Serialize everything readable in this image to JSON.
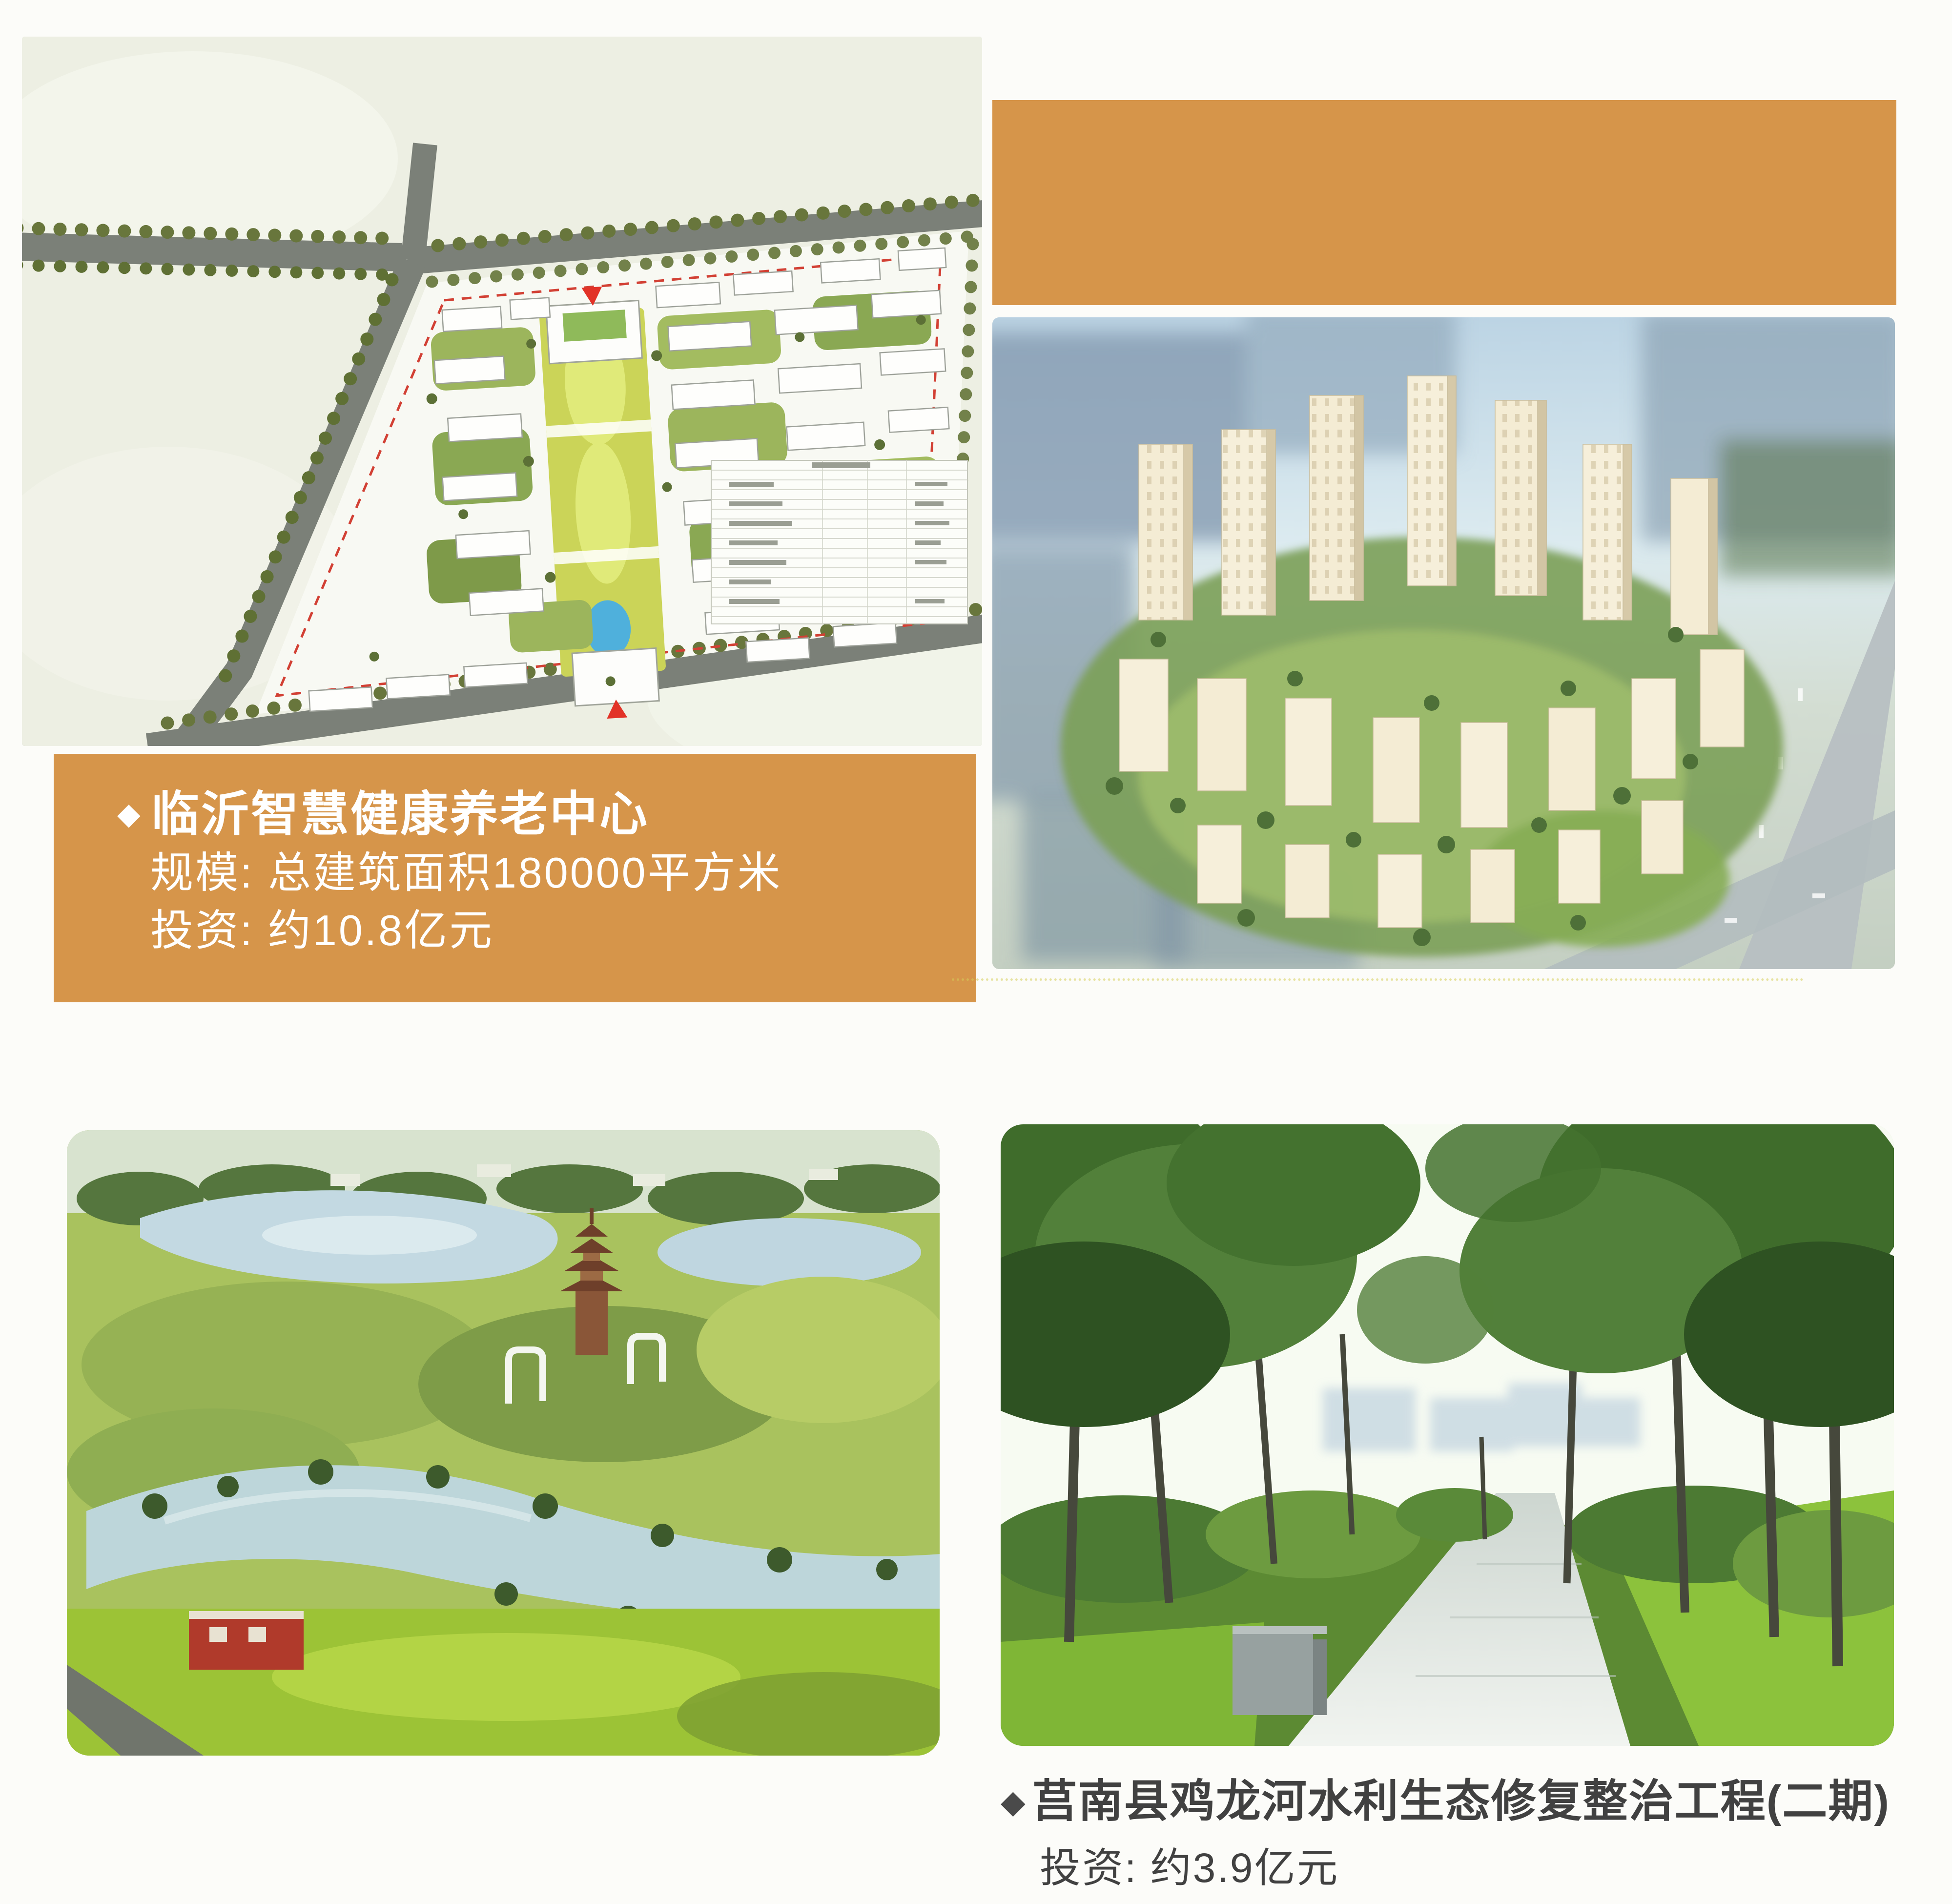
{
  "page": {
    "type": "brochure-page",
    "background": "#fcfcf9"
  },
  "colors": {
    "accent_orange": "#d6954a",
    "caption_text_on_orange": "#ffffff",
    "caption_text_dark": "#414141",
    "diamond_dark": "#4a4a4a",
    "boundary_red": "#d24034"
  },
  "projects": [
    {
      "bullet": "◆",
      "title": "临沂智慧健康养老中心",
      "lines": [
        "规模: 总建筑面积180000平方米",
        "投资: 约10.8亿元"
      ]
    },
    {
      "bullet": "◆",
      "title": "莒南县鸡龙河水利生态修复整治工程(二期)",
      "lines": [
        "投资: 约3.9亿元"
      ]
    }
  ],
  "figures": [
    {
      "name": "site-plan-drawing"
    },
    {
      "name": "orange-banner"
    },
    {
      "name": "aerial-rendering"
    },
    {
      "name": "park-aerial-photo"
    },
    {
      "name": "tree-path-photo"
    }
  ]
}
